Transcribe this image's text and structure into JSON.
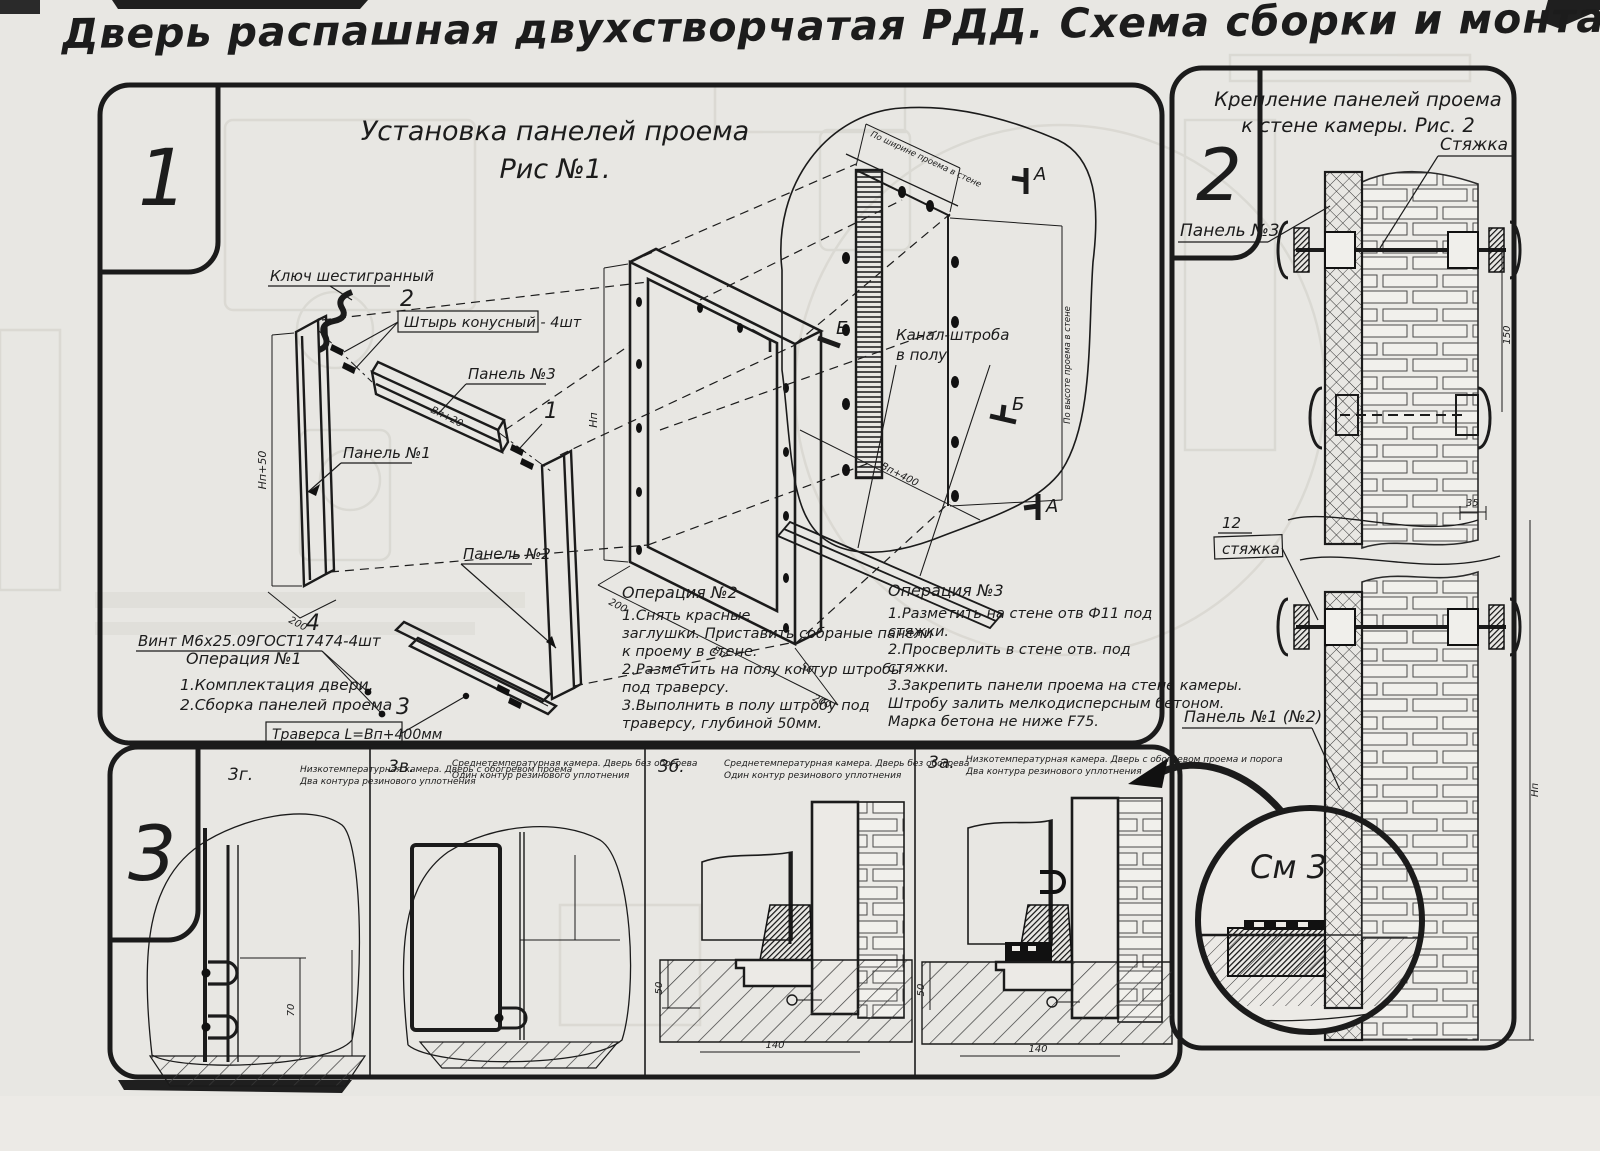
{
  "sheet": {
    "title": "Дверь распашная двухстворчатая РДД.  Схема сборки и монтажа №2"
  },
  "panel1": {
    "number": "1",
    "caption_line1": "Установка панелей проема",
    "caption_line2": "Рис №1.",
    "labels": {
      "hex_key": "Ключ шестигранный",
      "pin": "Штырь конусный - 4шт",
      "panel3": "Панель №3",
      "panel1": "Панель №1",
      "panel2": "Панель №2",
      "screw": "Винт М6х25.09ГОСТ17474-4шт",
      "traverse": "Траверса  L=Вп+400мм",
      "channel_line1": "Канал-штроба",
      "channel_line2": "в полу"
    },
    "callouts": {
      "c1": "1",
      "c2": "2",
      "c3": "3",
      "c4": "4"
    },
    "marks": {
      "a": "А",
      "b": "Б"
    },
    "dims": {
      "hp50": "Нп+50",
      "d200": "200",
      "bp20": "Вп+20",
      "hp": "Нп",
      "bp": "Вп",
      "d200b": "200",
      "d50": "50",
      "bp400": "Вп+400",
      "wall_w": "По ширине проема в стене",
      "wall_h": "По высоте проема в стене"
    },
    "op1": {
      "title": "Операция №1",
      "lines": [
        "1.Комплектация двери.",
        "2.Сборка панелей проема"
      ]
    },
    "op2": {
      "title": "Операция №2",
      "lines": [
        "1.Снять красные",
        "заглушки. Приставить собраные панели",
        "к проему в стене.",
        "2.Разметить на полу контур штробы",
        "под траверсу.",
        "3.Выполнить в полу штробу под",
        "траверсу, глубиной 50мм."
      ]
    },
    "op3": {
      "title": "Операция №3",
      "lines": [
        "1.Разметить на стене отв Ф11 под",
        "стяжки.",
        "2.Просверлить в стене отв.  под",
        "стяжки.",
        "3.Закрепить панели проема на стене камеры.",
        "Штробу залить мелкодисперсным бетоном.",
        "Марка бетона не ниже  F75."
      ]
    }
  },
  "panel2": {
    "number": "2",
    "caption_line1": "Крепление панелей проема",
    "caption_line2": "к стене камеры. Рис. 2",
    "labels": {
      "tie": "Стяжка",
      "panel3": "Панель №3",
      "tie12_num": "12",
      "tie12": "стяжка",
      "panel12": "Панель №1 (№2)",
      "see3": "См 3"
    },
    "dims": {
      "d150": "150",
      "d35": "35",
      "hp": "Нп"
    }
  },
  "panel3": {
    "number": "3",
    "sections": [
      {
        "id": "3г.",
        "caption_line1": "Низкотемпературная камера. Дверь с обогревом проема",
        "caption_line2": "Два контура резинового уплотнения",
        "dim1": "70"
      },
      {
        "id": "3в.",
        "caption_line1": "Среднетемпературная камера. Дверь без обогрева",
        "caption_line2": "Один контур резинового уплотнения"
      },
      {
        "id": "3б.",
        "caption_line1": "Среднетемпературная камера. Дверь без обогрева",
        "caption_line2": "Один контур резинового уплотнения",
        "dim1": "50",
        "dim2": "140"
      },
      {
        "id": "3а.",
        "caption_line1": "Низкотемпературная камера. Дверь с обогревом проема и порога",
        "caption_line2": "Два контура резинового уплотнения",
        "dim1": "50",
        "dim2": "140"
      }
    ]
  }
}
